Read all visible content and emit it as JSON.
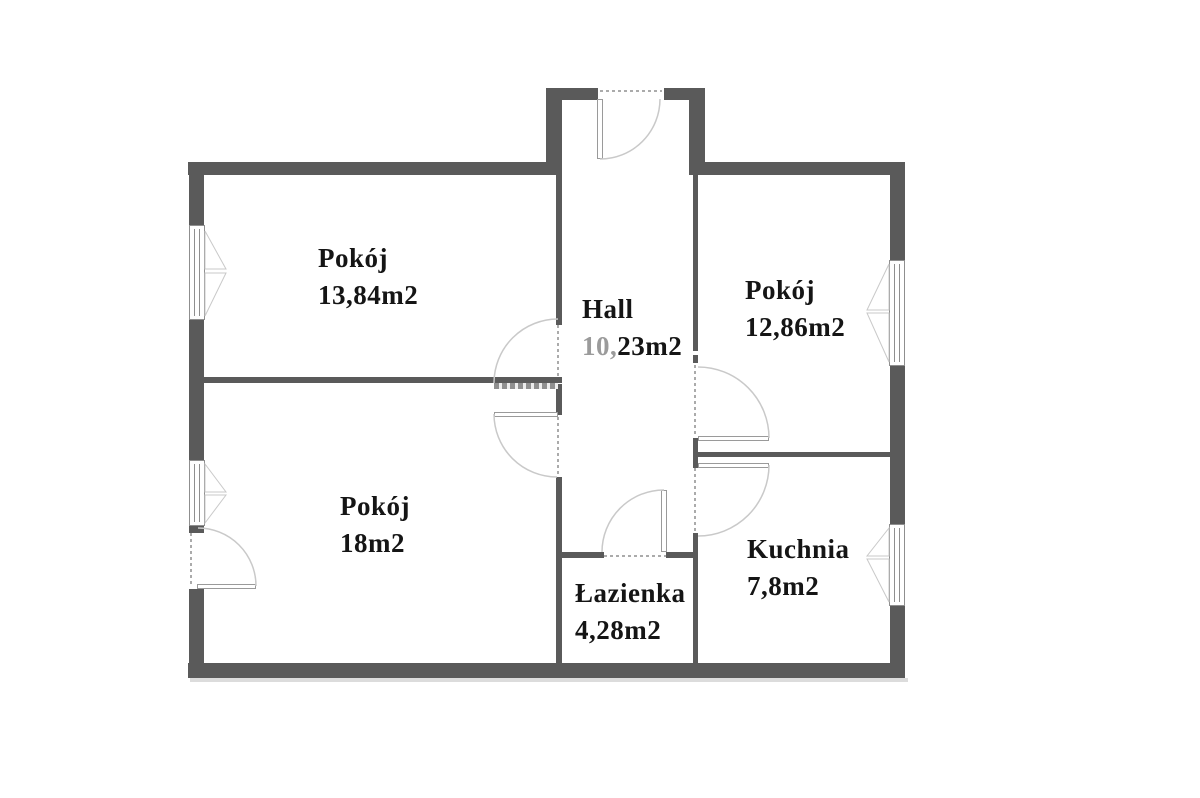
{
  "floorplan": {
    "type": "apartment-floor-plan",
    "rooms": [
      {
        "id": "pokoj-top-left",
        "name": "Pokój",
        "area": "13,84m2"
      },
      {
        "id": "hall",
        "name": "Hall",
        "area": "10,23m2",
        "area_muted": "10,",
        "area_rest": "23m2"
      },
      {
        "id": "pokoj-top-right",
        "name": "Pokój",
        "area": "12,86m2"
      },
      {
        "id": "pokoj-bottom-left",
        "name": "Pokój",
        "area": "18m2"
      },
      {
        "id": "kuchnia",
        "name": "Kuchnia",
        "area": "7,8m2"
      },
      {
        "id": "lazienka",
        "name": "Łazienka",
        "area": "4,28m2"
      }
    ],
    "colors": {
      "wall": "#5a5a5a",
      "door_arc": "#c9c9c9",
      "door_leaf": "#9a9a9a",
      "window_border": "#8f8f8f",
      "text": "#151515",
      "muted_text": "#9b9b9b",
      "shadow": "#dcdcdc",
      "background": "#ffffff"
    }
  }
}
